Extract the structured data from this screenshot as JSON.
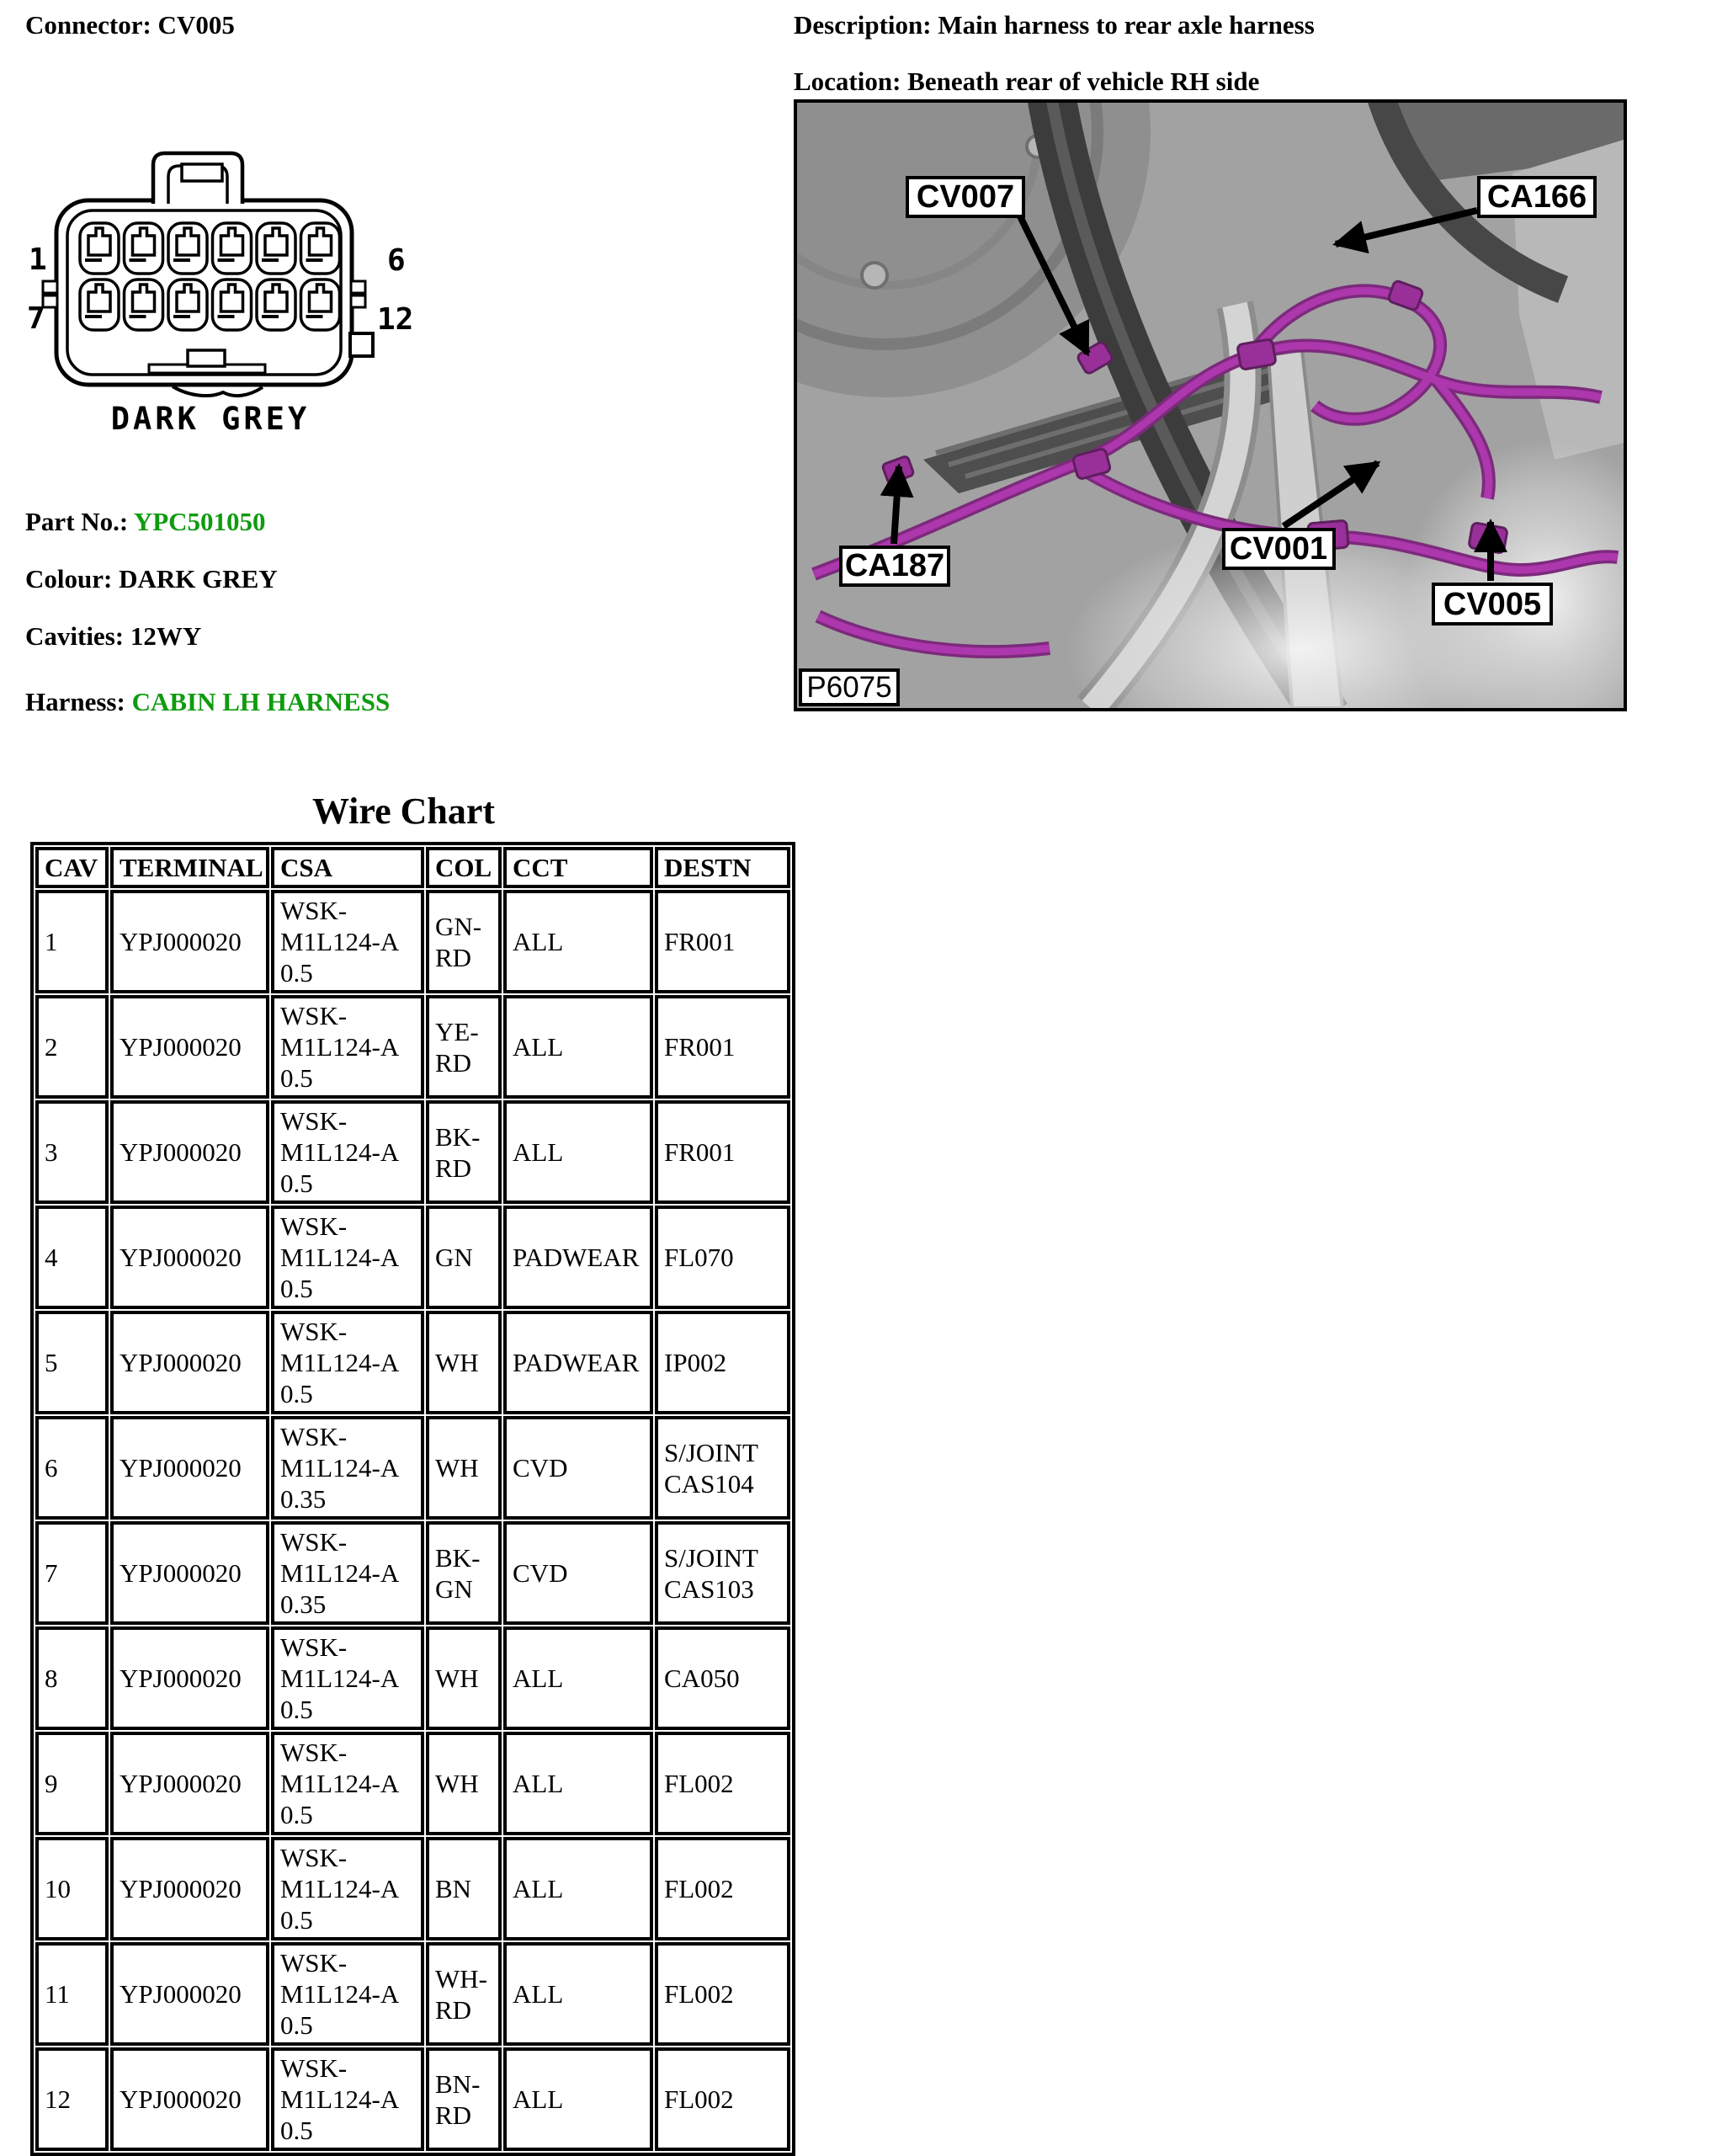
{
  "header": {
    "connector": "Connector: CV005",
    "description": "Description: Main harness to rear axle harness",
    "location": "Location: Beneath rear of vehicle RH side"
  },
  "diagram": {
    "pin_top_left": "1",
    "pin_top_right": "6",
    "pin_bottom_left": "7",
    "pin_bottom_right": "12",
    "caption": "DARK GREY"
  },
  "info": {
    "part_no_label": "Part No.:",
    "part_no_value": "YPC501050",
    "colour_label": "Colour:",
    "colour_value": "DARK GREY",
    "cavities_label": "Cavities:",
    "cavities_value": "12WY",
    "harness_label": "Harness:",
    "harness_value": "CABIN LH HARNESS"
  },
  "photo": {
    "code": "P6075",
    "callouts": [
      {
        "label": "CV007"
      },
      {
        "label": "CA166"
      },
      {
        "label": "CA187"
      },
      {
        "label": "CV001"
      },
      {
        "label": "CV005"
      }
    ]
  },
  "wire_chart": {
    "title": "Wire Chart",
    "columns": [
      "CAV",
      "TERMINAL",
      "CSA",
      "COL",
      "CCT",
      "DESTN"
    ],
    "rows": [
      {
        "cav": "1",
        "terminal": "YPJ000020",
        "csa": "WSK-\nM1L124-A\n0.5",
        "col": "GN-\nRD",
        "cct": "ALL",
        "destn": "FR001"
      },
      {
        "cav": "2",
        "terminal": "YPJ000020",
        "csa": "WSK-\nM1L124-A\n0.5",
        "col": "YE-\nRD",
        "cct": "ALL",
        "destn": "FR001"
      },
      {
        "cav": "3",
        "terminal": "YPJ000020",
        "csa": "WSK-\nM1L124-A\n0.5",
        "col": "BK-\nRD",
        "cct": "ALL",
        "destn": "FR001"
      },
      {
        "cav": "4",
        "terminal": "YPJ000020",
        "csa": "WSK-\nM1L124-A\n0.5",
        "col": "GN",
        "cct": "PADWEAR",
        "destn": "FL070"
      },
      {
        "cav": "5",
        "terminal": "YPJ000020",
        "csa": "WSK-\nM1L124-A\n0.5",
        "col": "WH",
        "cct": "PADWEAR",
        "destn": "IP002"
      },
      {
        "cav": "6",
        "terminal": "YPJ000020",
        "csa": "WSK-\nM1L124-A\n0.35",
        "col": "WH",
        "cct": "CVD",
        "destn": "S/JOINT\nCAS104"
      },
      {
        "cav": "7",
        "terminal": "YPJ000020",
        "csa": "WSK-\nM1L124-A\n0.35",
        "col": "BK-\nGN",
        "cct": "CVD",
        "destn": "S/JOINT\nCAS103"
      },
      {
        "cav": "8",
        "terminal": "YPJ000020",
        "csa": "WSK-\nM1L124-A\n0.5",
        "col": "WH",
        "cct": "ALL",
        "destn": "CA050"
      },
      {
        "cav": "9",
        "terminal": "YPJ000020",
        "csa": "WSK-\nM1L124-A\n0.5",
        "col": "WH",
        "cct": "ALL",
        "destn": "FL002"
      },
      {
        "cav": "10",
        "terminal": "YPJ000020",
        "csa": "WSK-\nM1L124-A\n0.5",
        "col": "BN",
        "cct": "ALL",
        "destn": "FL002"
      },
      {
        "cav": "11",
        "terminal": "YPJ000020",
        "csa": "WSK-\nM1L124-A\n0.5",
        "col": "WH-\nRD",
        "cct": "ALL",
        "destn": "FL002"
      },
      {
        "cav": "12",
        "terminal": "YPJ000020",
        "csa": "WSK-\nM1L124-A\n0.5",
        "col": "BN-\nRD",
        "cct": "ALL",
        "destn": "FL002"
      }
    ]
  },
  "colors": {
    "accent_green": "#0f9b0f",
    "harness_magenta": "#ad37ad"
  }
}
